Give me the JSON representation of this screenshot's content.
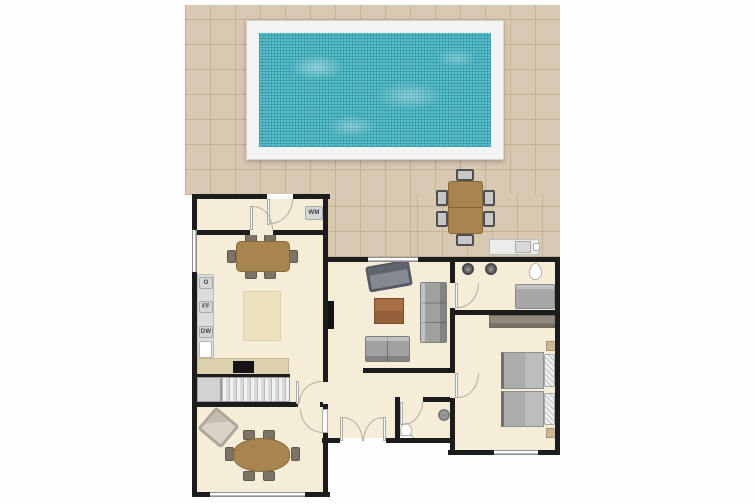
{
  "plan": {
    "type": "floor-plan",
    "view": "top-down"
  },
  "labels": {
    "washing_machine": "WM",
    "oven": "O",
    "fridge_freezer": "FF",
    "dishwasher": "DW"
  },
  "colors": {
    "wall": "#1c1c1c",
    "floor": "#f6edd8",
    "patio-tile": "#d9c9b3",
    "patio-grout": "#c3b198",
    "pool-deck": "#f3f3f3",
    "pool-water": "#56bfca",
    "wood": "#a8854f",
    "wood-dark": "#87683c",
    "chair": "#7b7366",
    "counter": "#dcdcdc",
    "counter-tan": "#ddd0ae",
    "rug": "#ece0bf",
    "sofa": "#9fa1a1",
    "bed": "#b4b4b4",
    "wardrobe": "#8f887b",
    "nightstand": "#cbb896",
    "label-bg": "#d6d6d6",
    "label-text": "#3f3f3f",
    "door": "#b3ada2"
  }
}
